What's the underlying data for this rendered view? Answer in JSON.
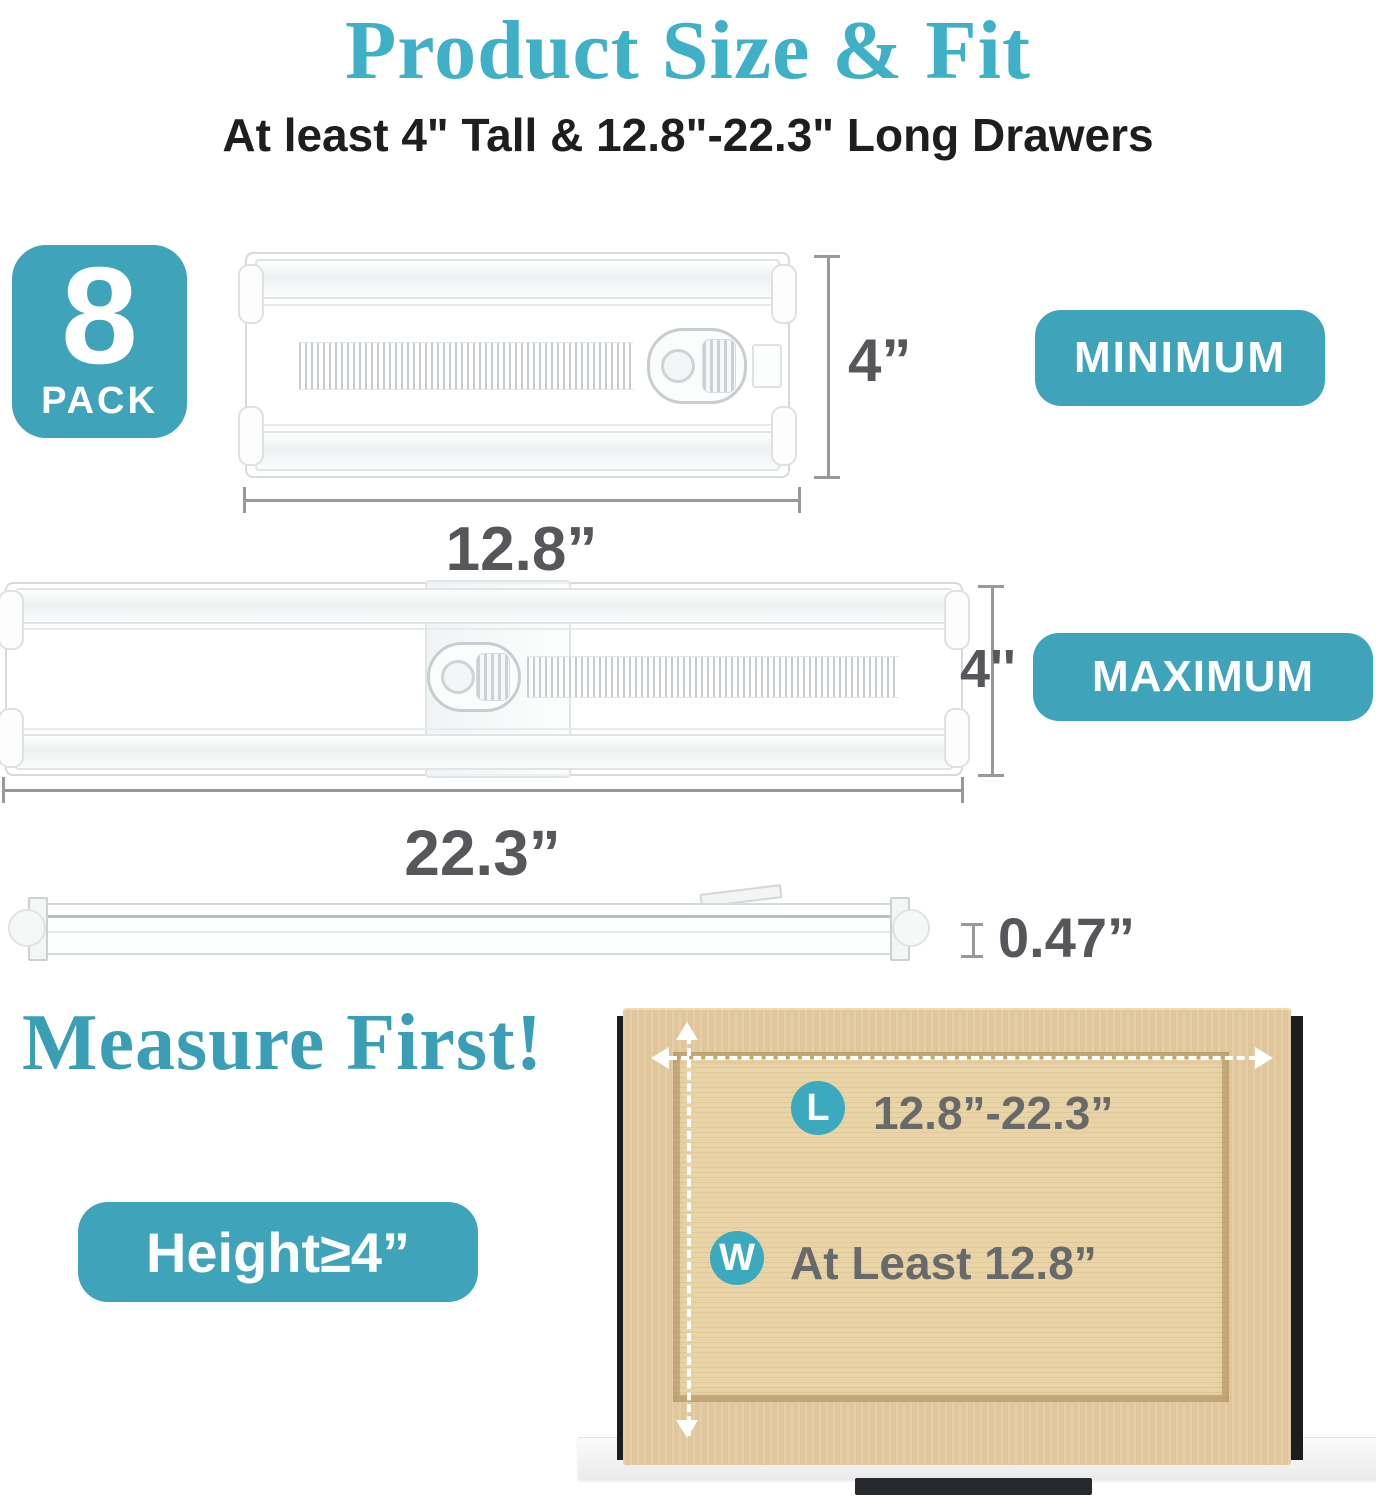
{
  "header": {
    "title": "Product Size & Fit",
    "subtitle": "At least 4\" Tall & 12.8\"-22.3\" Long Drawers"
  },
  "pack_badge": {
    "count": "8",
    "label": "PACK"
  },
  "minimum": {
    "badge": "MINIMUM",
    "height": "4”",
    "width": "12.8”"
  },
  "maximum": {
    "badge": "MAXIMUM",
    "height": "4''",
    "width": "22.3”"
  },
  "profile": {
    "thickness": "0.47”"
  },
  "measure": {
    "heading": "Measure First!",
    "height_badge": "Height≥4”"
  },
  "drawer": {
    "length_key": "L",
    "length_value": "12.8”-22.3”",
    "width_key": "W",
    "width_value": "At Least 12.8”"
  },
  "colors": {
    "accent_teal": "#3FA4B9",
    "title_teal": "#3FB0C5",
    "dimension_gray": "#55575A",
    "wood": "#E0C69A"
  }
}
